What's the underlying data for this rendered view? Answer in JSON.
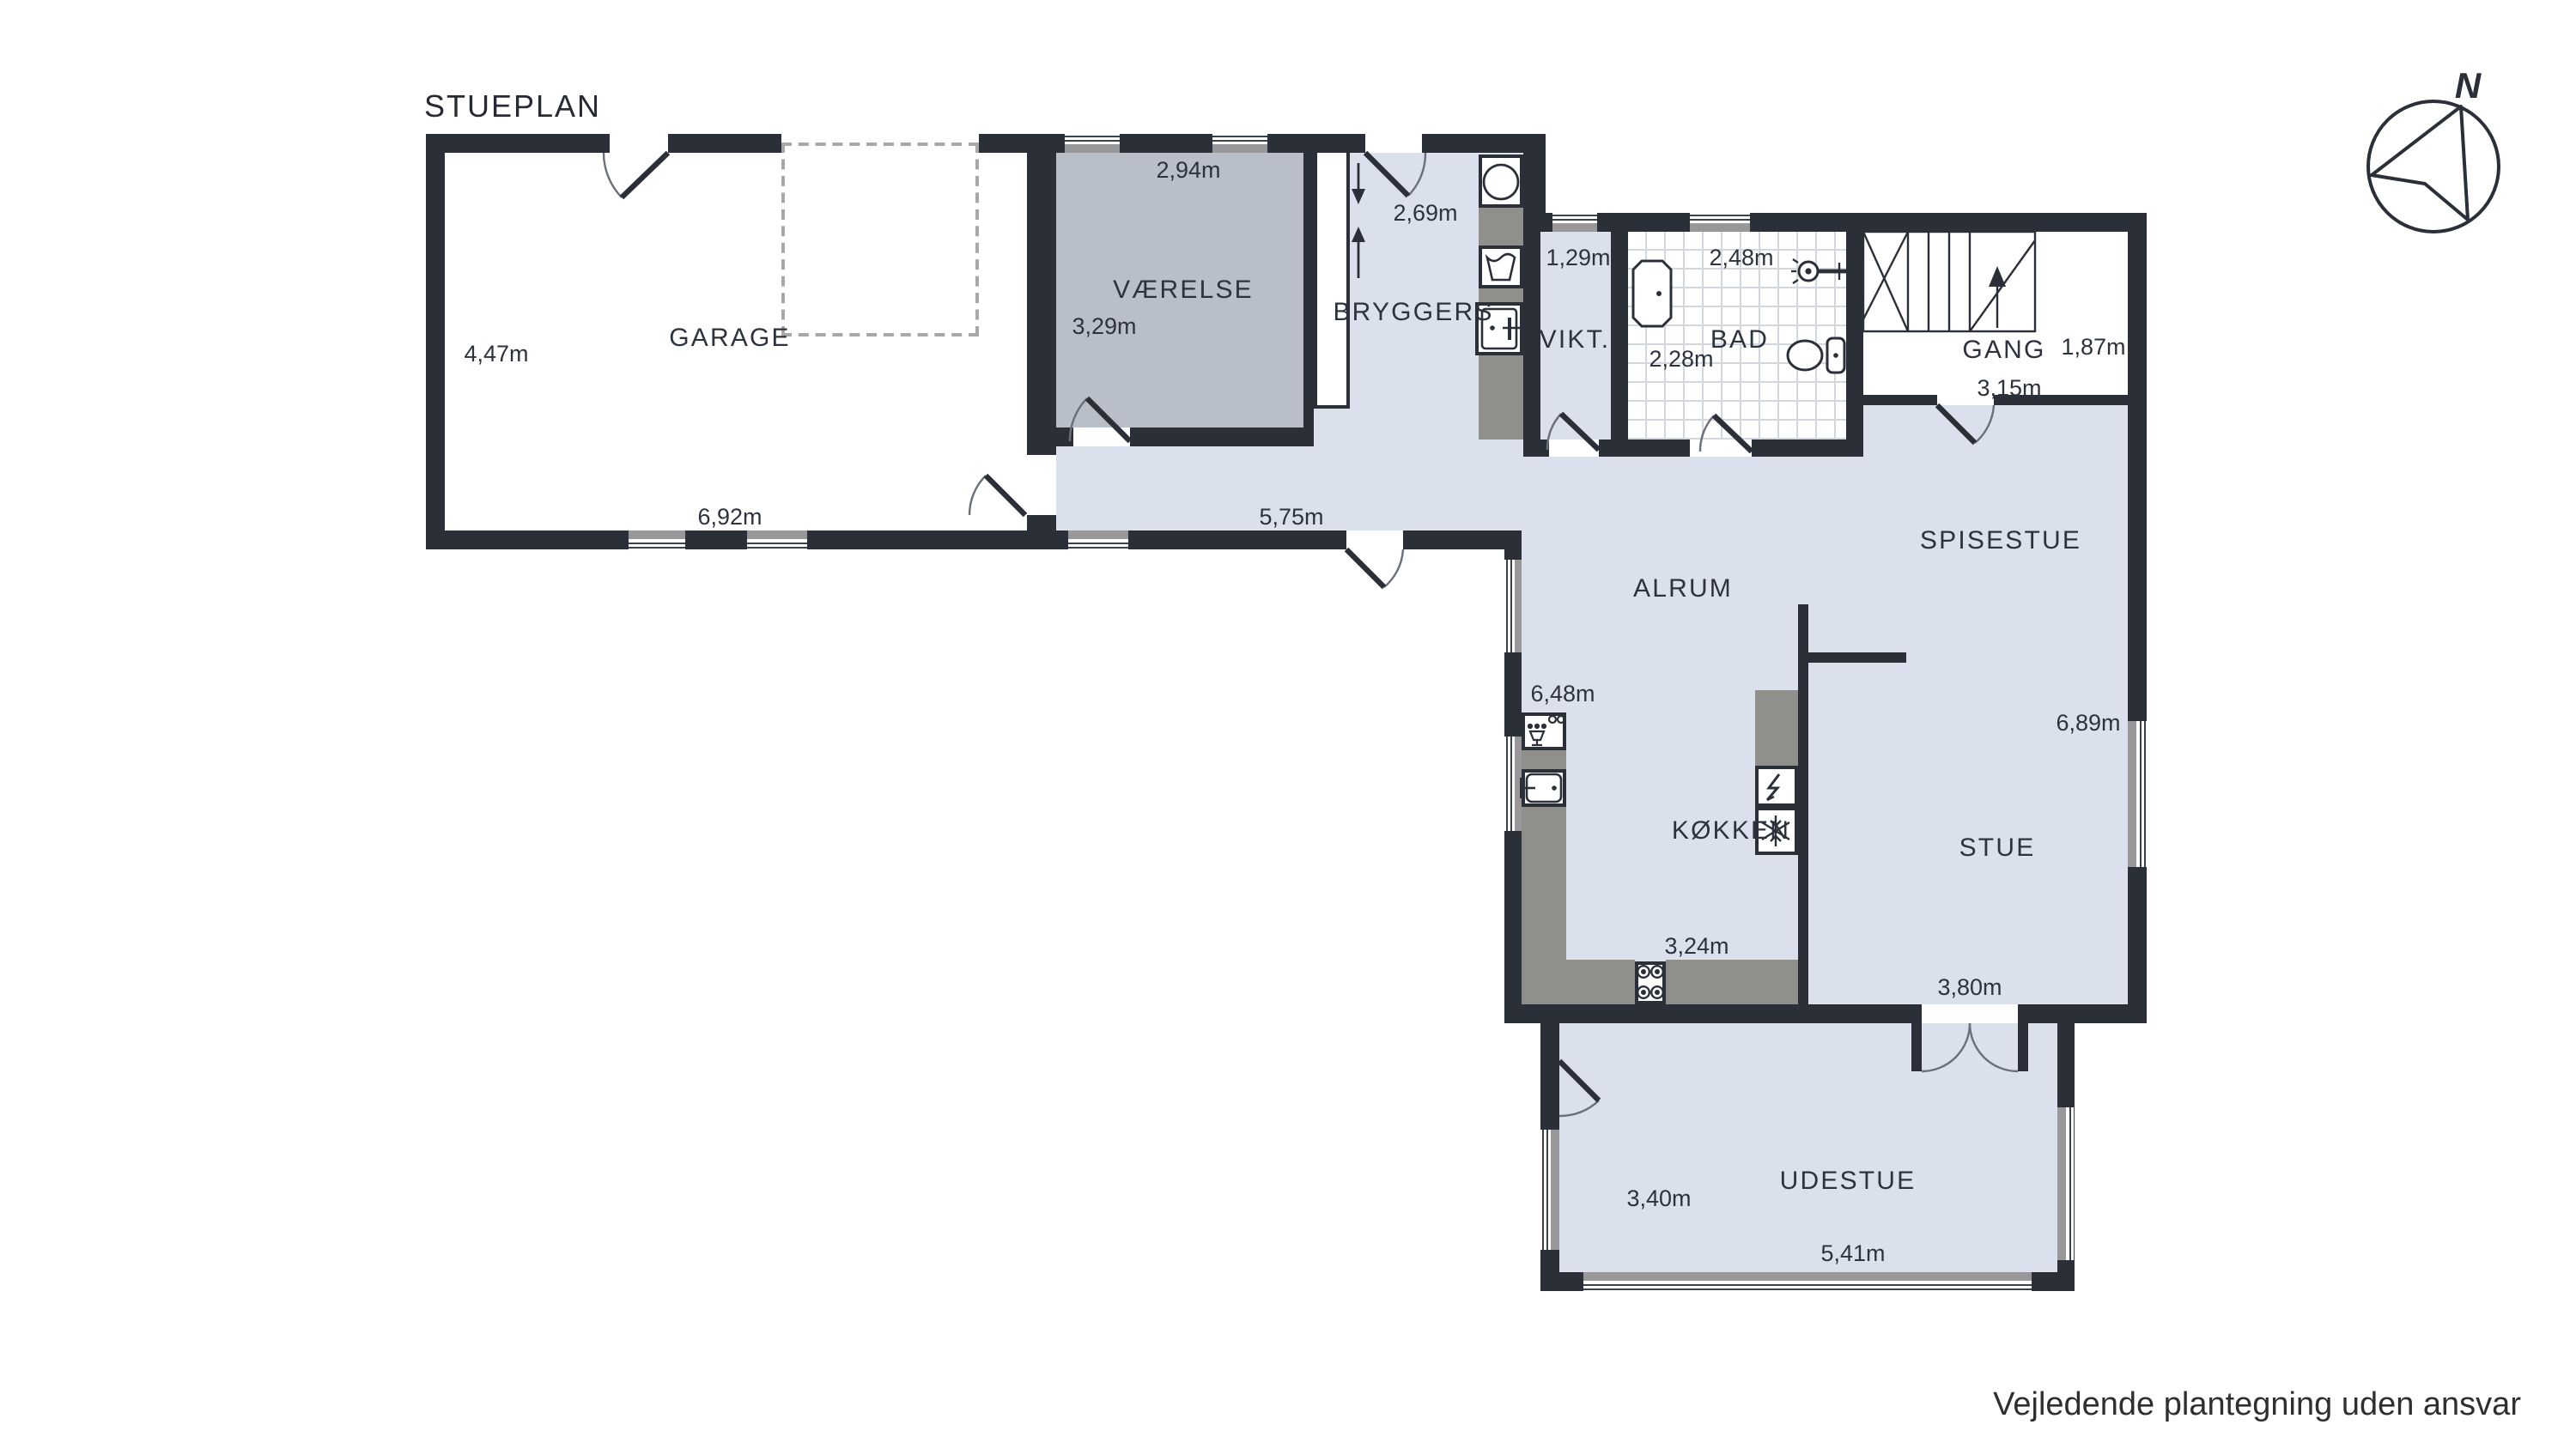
{
  "title": "STUEPLAN",
  "disclaimer": "Vejledende plantegning uden ansvar",
  "compass": {
    "north": "N"
  },
  "rooms": {
    "garage": {
      "name": "GARAGE",
      "width": "6,92m",
      "height": "4,47m"
    },
    "vaerelse": {
      "name": "VÆRELSE",
      "width": "2,94m",
      "height": "3,29m"
    },
    "bryggers": {
      "name": "BRYGGERS",
      "width": "2,69m"
    },
    "vikt": {
      "name": "VIKT.",
      "width": "1,29m"
    },
    "bad": {
      "name": "BAD",
      "width": "2,48m",
      "height": "2,28m"
    },
    "gang": {
      "name": "GANG",
      "width": "3,15m",
      "height": "1,87m"
    },
    "alrum": {
      "name": "ALRUM",
      "hall_width": "5,75m"
    },
    "spisestue": {
      "name": "SPISESTUE"
    },
    "koekken": {
      "name": "KØKKEN",
      "width": "3,24m",
      "height": "6,48m"
    },
    "stue": {
      "name": "STUE",
      "width": "3,80m",
      "height": "6,89m"
    },
    "udestue": {
      "name": "UDESTUE",
      "width": "5,41m",
      "height": "3,40m"
    }
  },
  "colors": {
    "wall": "#2a2f38",
    "floor": "#dbe1ec",
    "room_dark": "#b9bfc9",
    "counter": "#8f8f8c",
    "window_band": "#98989a"
  }
}
